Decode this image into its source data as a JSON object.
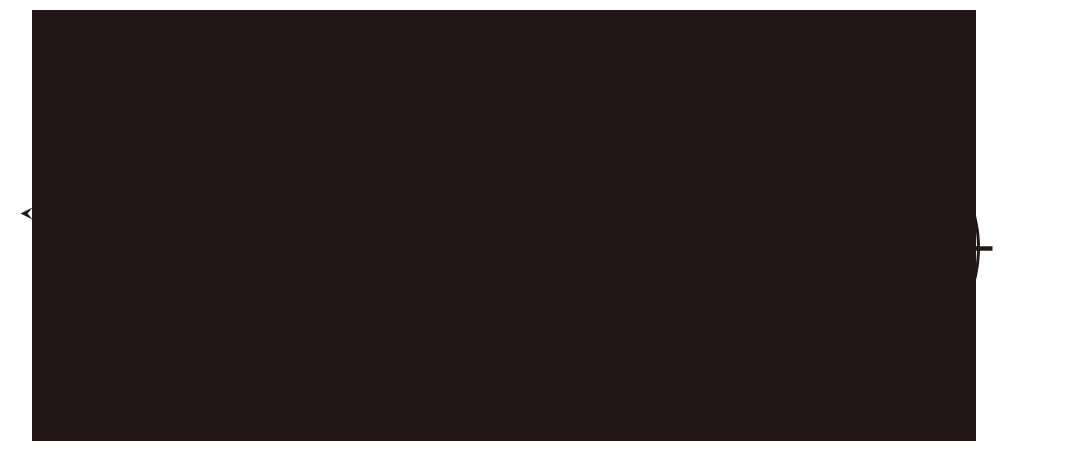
{
  "meta": {
    "description": "Mostly-redacted diagram: a large dark overlay rectangle hides a diagram; an arrowhead, a circle rim and a connector line protrude at the edges",
    "visible_text": ""
  },
  "colors": {
    "ink": "#231815",
    "background": "#ffffff"
  },
  "shapes": {
    "overlay": {
      "name": "redaction-overlay",
      "x": 32,
      "y": 10,
      "width": 944,
      "height": 431
    },
    "left_arrowhead": {
      "name": "left-arrow-tip",
      "tip_x": 20.5,
      "tip_y": 213.5
    },
    "circle_fragment": {
      "name": "circle-node-rim",
      "cx": 849,
      "cy": 248,
      "r": 129.5,
      "stroke_width": 3
    },
    "connector": {
      "name": "connector-line",
      "y": 248.5,
      "x_end": 992.5,
      "stroke_width": 4.5
    }
  }
}
